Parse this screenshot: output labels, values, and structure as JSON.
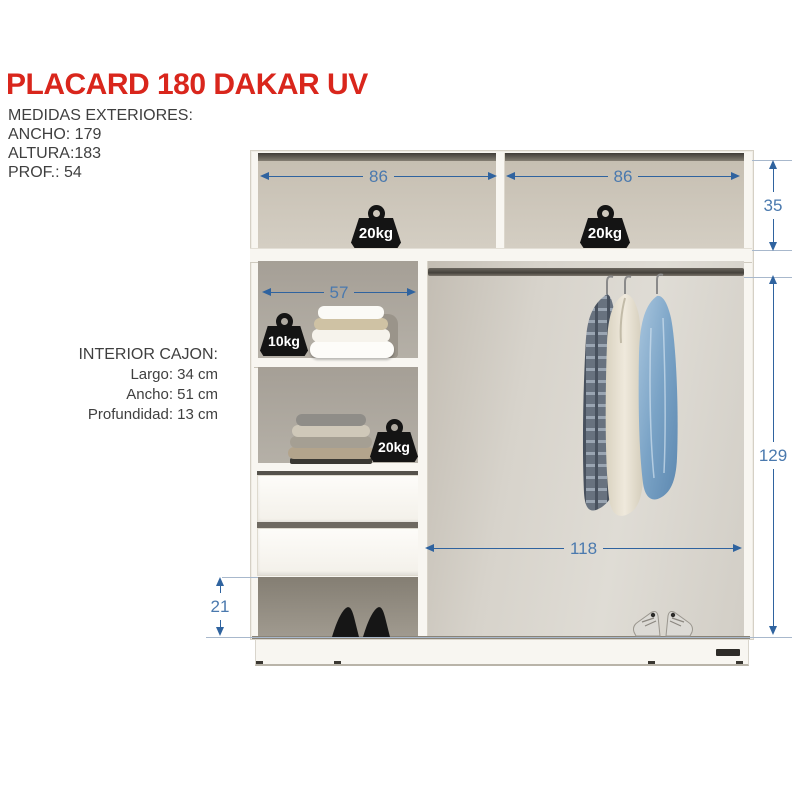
{
  "header": {
    "title": "PLACARD 180 DAKAR UV",
    "subtitle": "MEDIDAS EXTERIORES:",
    "specs": [
      "ANCHO: 179",
      "ALTURA:183",
      "PROF.: 54"
    ]
  },
  "drawer_info": {
    "title": "INTERIOR CAJON:",
    "lines": [
      "Largo: 34 cm",
      "Ancho: 51 cm",
      "Profundidad: 13 cm"
    ]
  },
  "diagram": {
    "dimensions": {
      "top_left_width": "86",
      "top_right_width": "86",
      "top_height": "35",
      "shelf_width": "57",
      "main_height": "129",
      "bottom_width": "118",
      "shoe_height": "21"
    },
    "weights": {
      "top_left": "20kg",
      "top_right": "20kg",
      "towel_shelf": "10kg",
      "sweater_shelf": "20kg"
    },
    "colors": {
      "accent_red": "#d9261c",
      "dimension_blue": "#2f639f"
    }
  }
}
